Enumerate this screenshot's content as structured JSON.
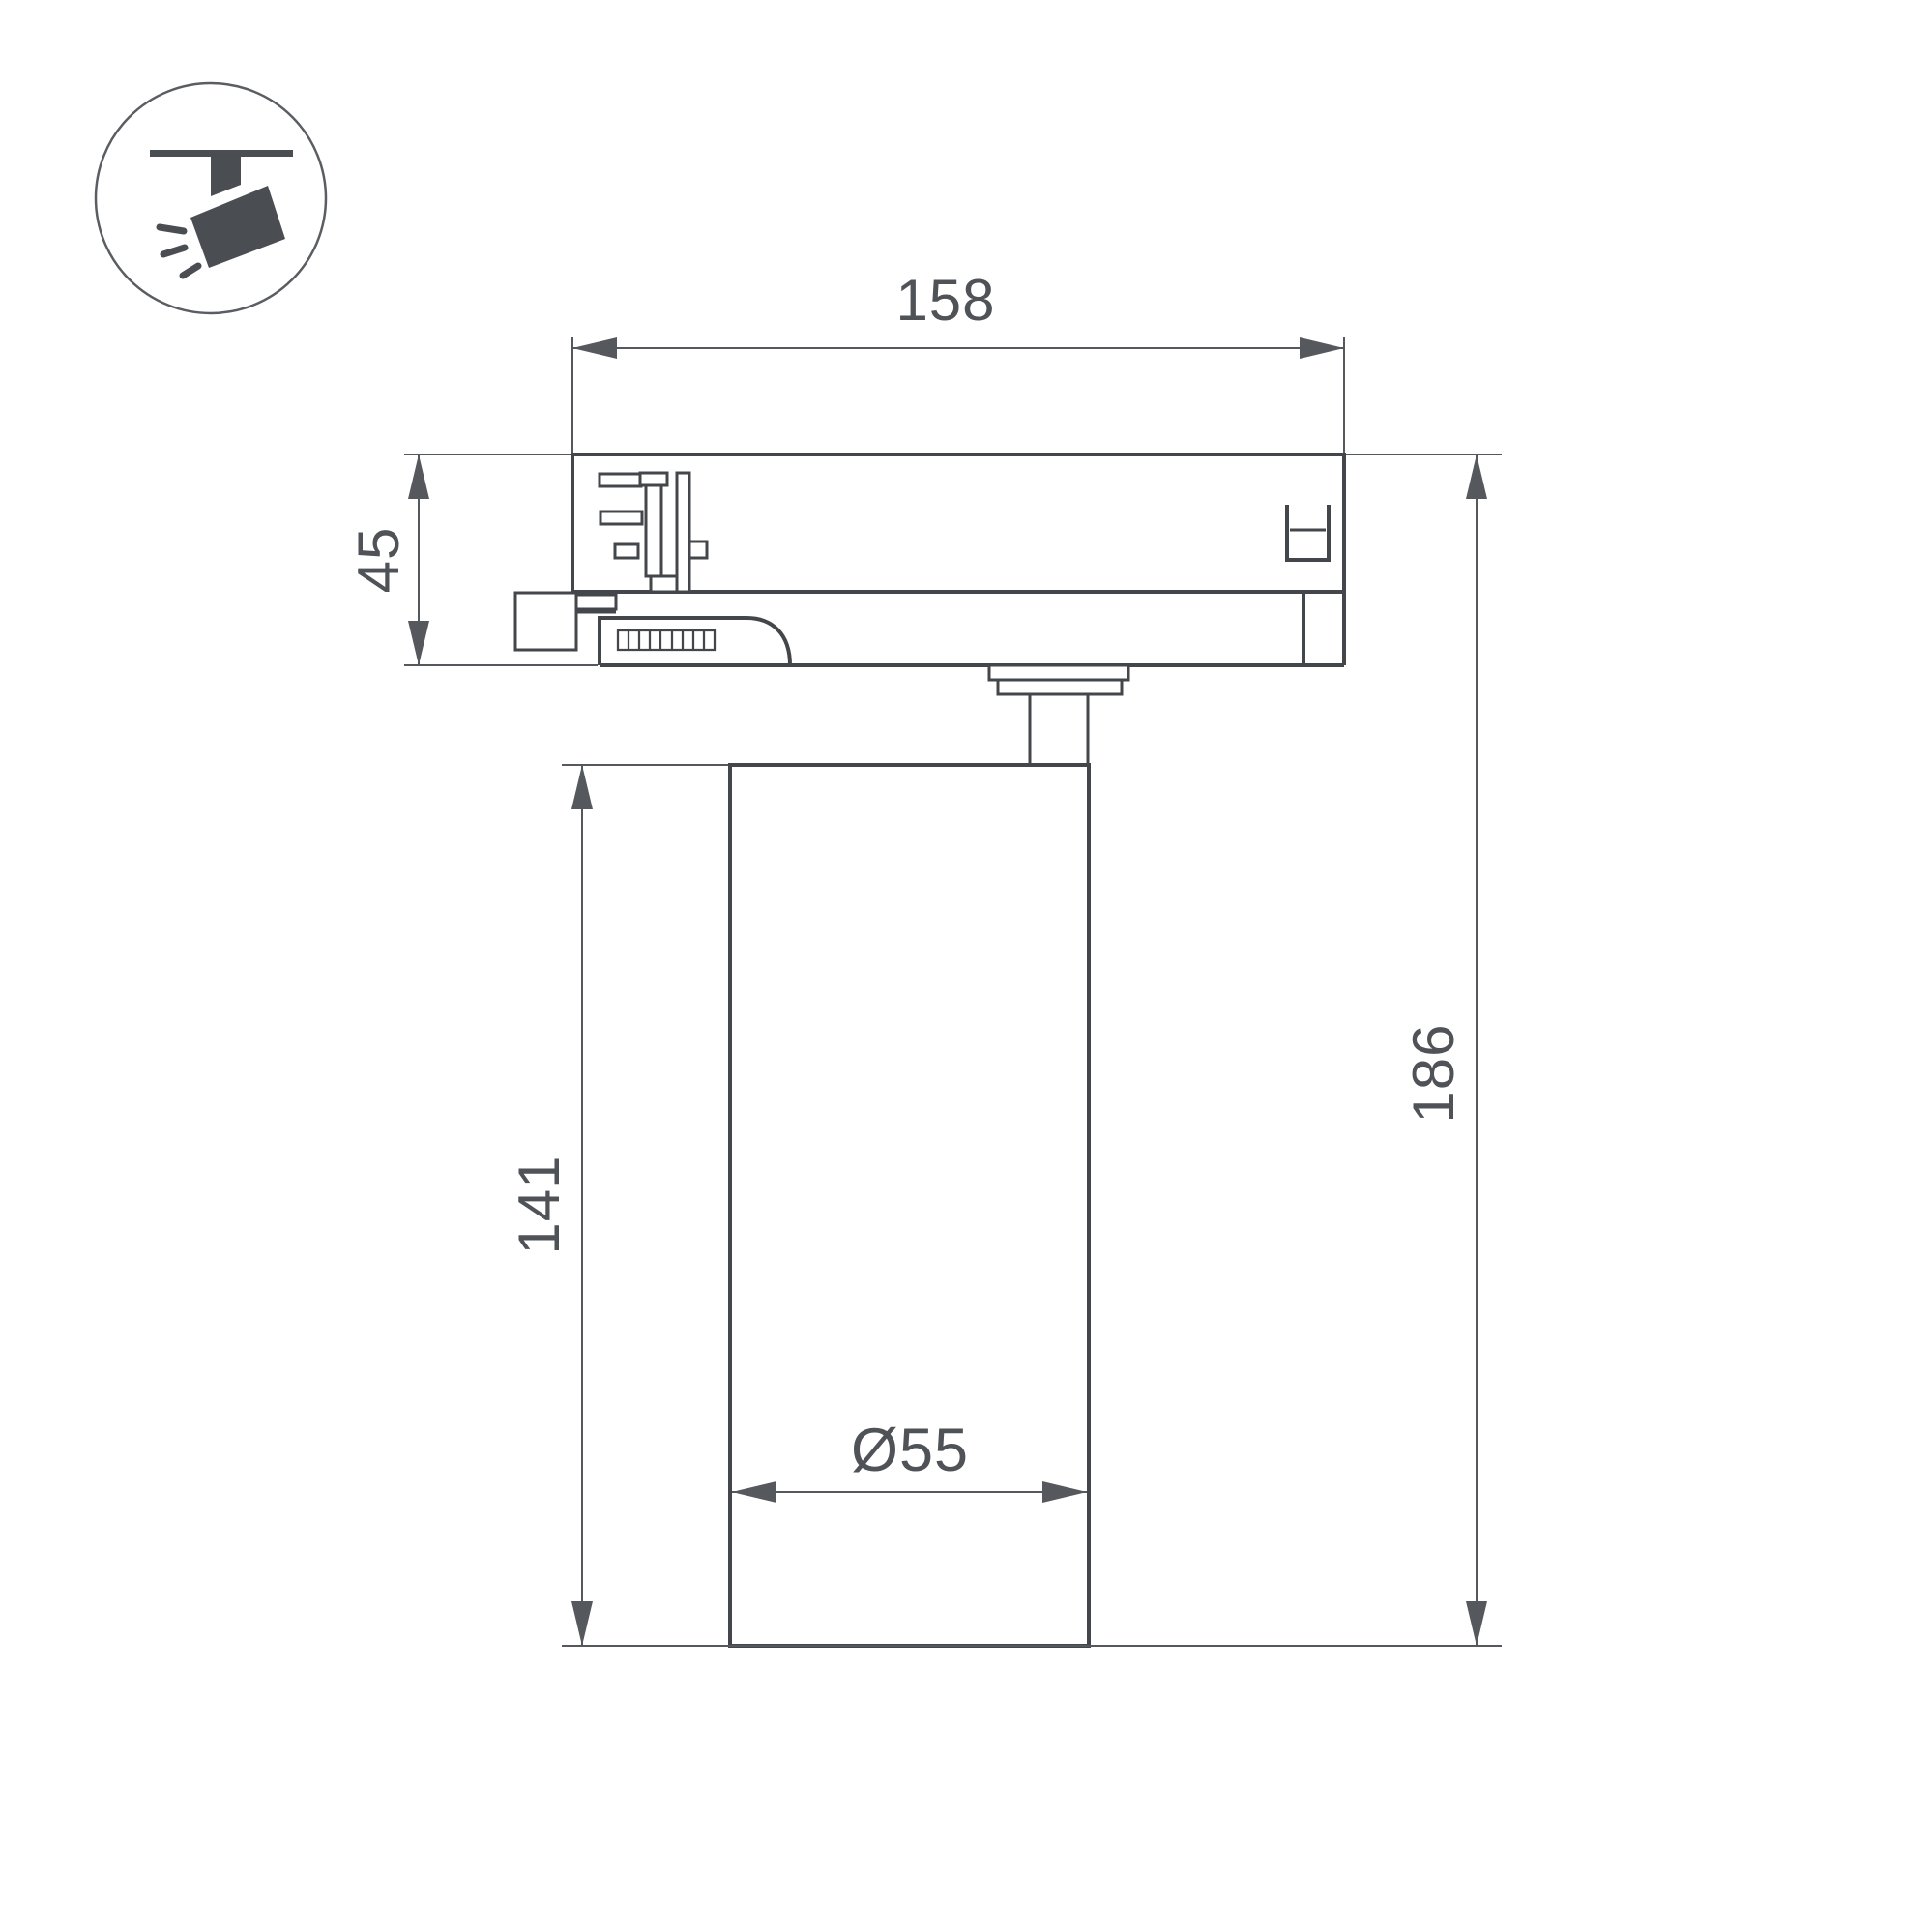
{
  "drawing": {
    "type": "technical-dimension-drawing",
    "subject": "track-mounted spotlight, side elevation"
  },
  "icon": {
    "name": "ceiling-track-spotlight-pictogram"
  },
  "dimensions": {
    "track_adapter_width": "158",
    "track_adapter_height": "45",
    "lamp_body_height": "141",
    "total_height": "186",
    "lamp_body_diameter": "Ø55"
  },
  "colors": {
    "background": "#ffffff",
    "outline": "#43464a",
    "dimension": "#55585c",
    "text": "#4f5256",
    "icon": "#4a4e53"
  }
}
